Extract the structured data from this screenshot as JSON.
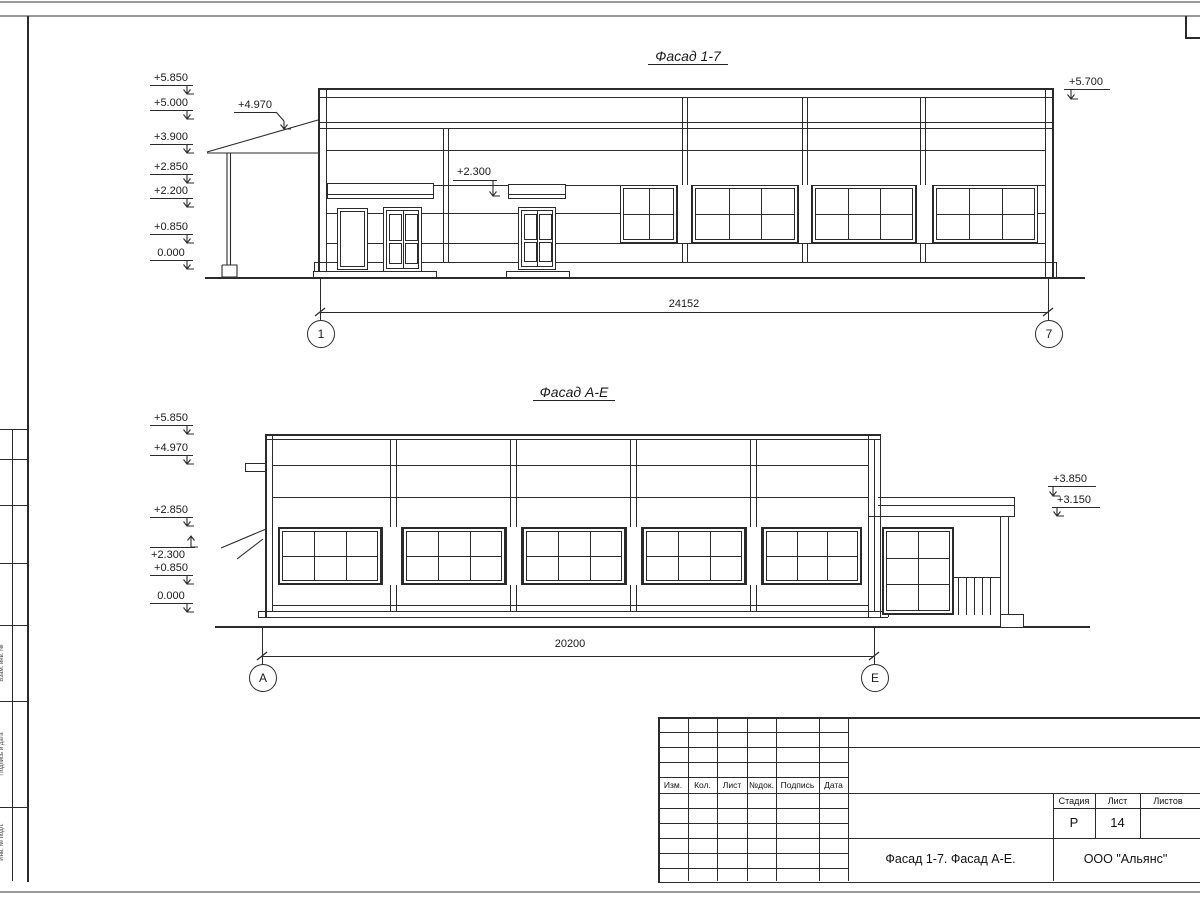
{
  "drawing": {
    "facade1": {
      "title": "Фасад 1-7",
      "elevation_marks": [
        "+5.850",
        "+5.000",
        "+3.900",
        "+2.850",
        "+2.200",
        "+0.850",
        "0.000"
      ],
      "canopy_mark": "+4.970",
      "door_mark": "+2.300",
      "right_mark": "+5.700",
      "dimension": "24152",
      "axis_left": "1",
      "axis_right": "7"
    },
    "facade2": {
      "title": "Фасад А-Е",
      "elevation_marks": [
        "+5.850",
        "+4.970",
        "+2.850",
        "+0.850",
        "0.000"
      ],
      "awning_mark": "+2.300",
      "right_marks": [
        "+3.850",
        "+3.150"
      ],
      "dimension": "20200",
      "axis_left": "А",
      "axis_right": "Е"
    },
    "title_block": {
      "revision_headers": [
        "Изм.",
        "Кол.",
        "Лист",
        "№док.",
        "Подпись",
        "Дата"
      ],
      "stage_label": "Стадия",
      "sheet_label": "Лист",
      "sheets_label": "Листов",
      "stage_value": "Р",
      "sheet_value": "14",
      "doc_title": "Фасад 1-7. Фасад А-Е.",
      "company": "ООО \"Альянс\""
    },
    "side_stamp_labels": [
      "Взам. инв. №",
      "Подпись и дата",
      "Инв. № подл."
    ]
  }
}
